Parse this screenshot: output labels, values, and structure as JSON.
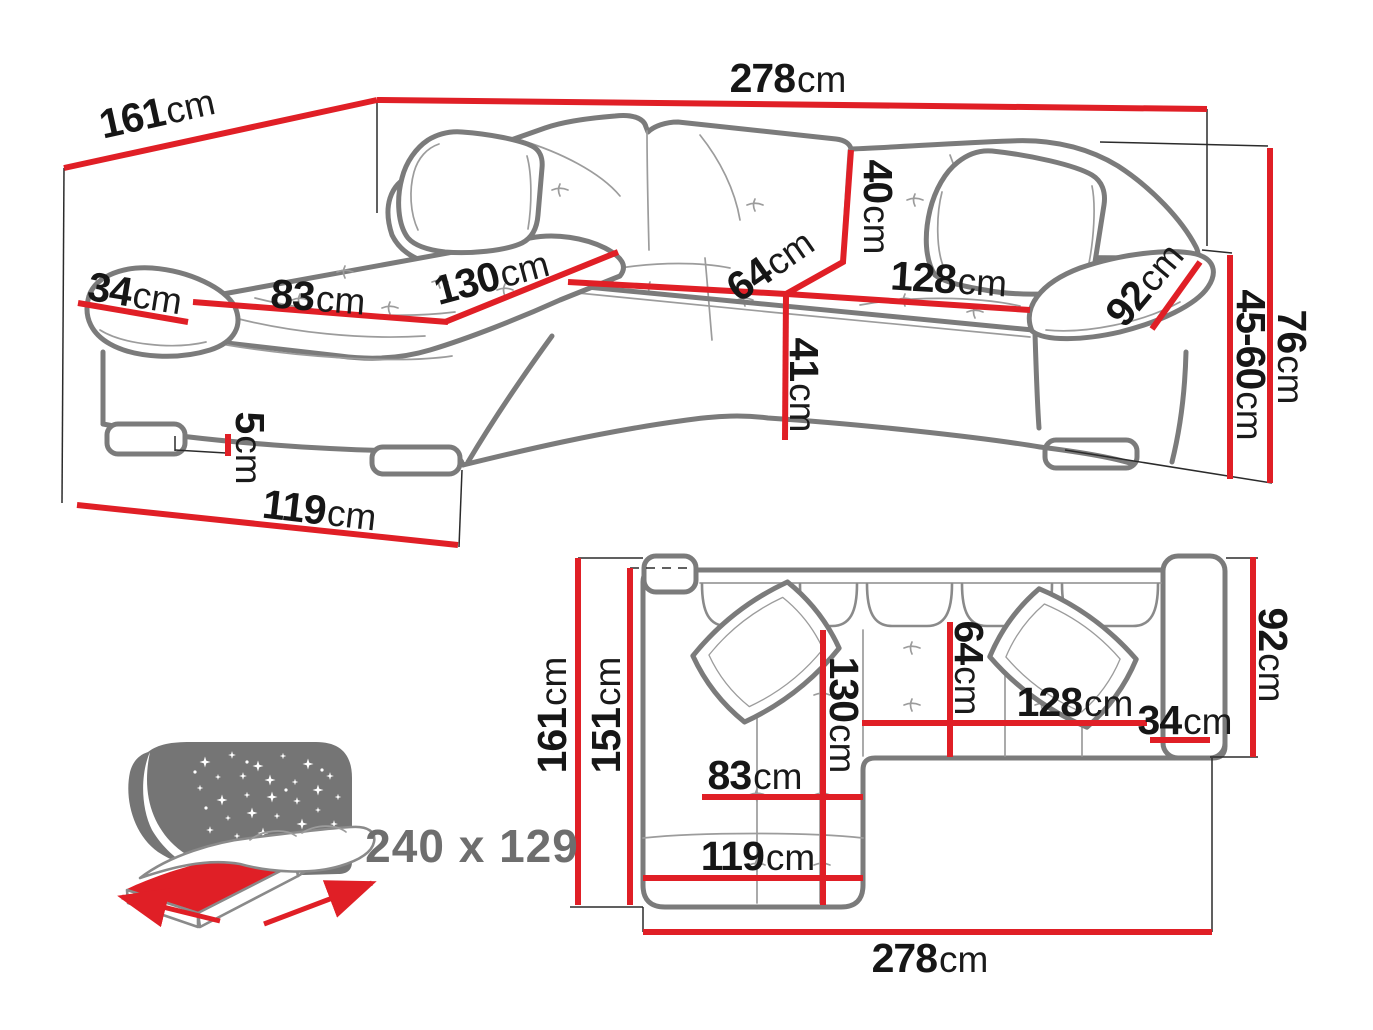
{
  "colors": {
    "dimension_red": "#e01f26",
    "sofa_outline_gray": "#7b7b7b",
    "detail_gray": "#9c9c9c",
    "label_black": "#161616",
    "muted_gray": "#6e6e6e",
    "star_panel_gray": "#757575",
    "background": "#ffffff"
  },
  "perspective": {
    "d161": {
      "num": "161",
      "unit": "cm"
    },
    "d278": {
      "num": "278",
      "unit": "cm"
    },
    "d40": {
      "num": "40",
      "unit": "cm"
    },
    "d64": {
      "num": "64",
      "unit": "cm"
    },
    "d128": {
      "num": "128",
      "unit": "cm"
    },
    "d92": {
      "num": "92",
      "unit": "cm"
    },
    "d76": {
      "num": "76",
      "unit": "cm"
    },
    "d45_60": {
      "num": "45-60",
      "unit": "cm"
    },
    "d41": {
      "num": "41",
      "unit": "cm"
    },
    "d130": {
      "num": "130",
      "unit": "cm"
    },
    "d83": {
      "num": "83",
      "unit": "cm"
    },
    "d34": {
      "num": "34",
      "unit": "cm"
    },
    "d5": {
      "num": "5",
      "unit": "cm"
    },
    "d119": {
      "num": "119",
      "unit": "cm"
    }
  },
  "plan": {
    "p161": {
      "num": "161",
      "unit": "cm"
    },
    "p151": {
      "num": "151",
      "unit": "cm"
    },
    "p130": {
      "num": "130",
      "unit": "cm"
    },
    "p64": {
      "num": "64",
      "unit": "cm"
    },
    "p128": {
      "num": "128",
      "unit": "cm"
    },
    "p34": {
      "num": "34",
      "unit": "cm"
    },
    "p92": {
      "num": "92",
      "unit": "cm"
    },
    "p83": {
      "num": "83",
      "unit": "cm"
    },
    "p119": {
      "num": "119",
      "unit": "cm"
    },
    "p278": {
      "num": "278",
      "unit": "cm"
    }
  },
  "sleeping_function": {
    "size": "240 x 129"
  }
}
